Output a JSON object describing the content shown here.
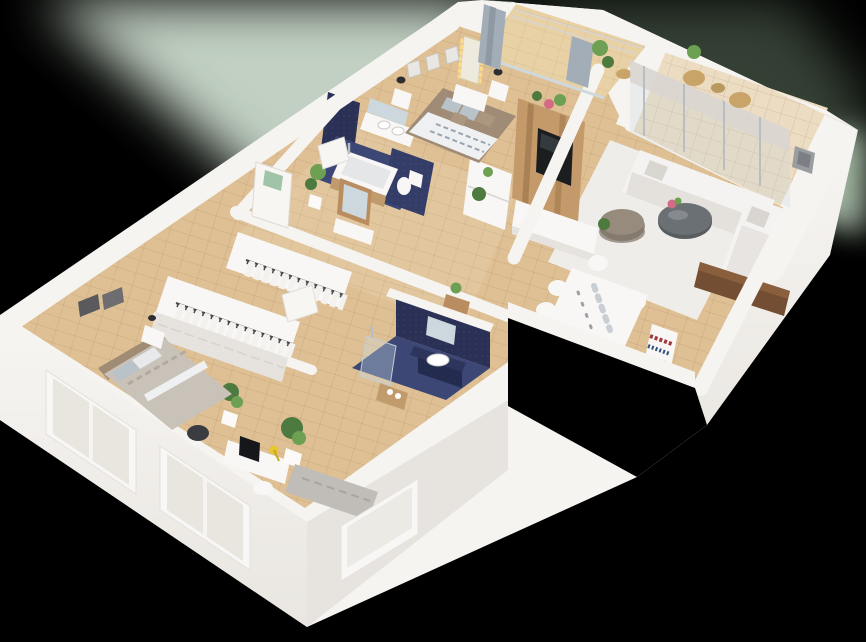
{
  "meta": {
    "kind": "3d-isometric-floorplan-render",
    "view": "cutaway-from-above",
    "visible_text": ""
  },
  "background": {
    "base": "#000000",
    "glow_primary": "#ccdccd",
    "glow_secondary": "#7e997f",
    "glow_accent": "#b7cdb7"
  },
  "palette": {
    "wallTop": "#f6f4f1",
    "facade": "#f3f1ed",
    "facadeShade": "#e7e4df",
    "woodFloor": "#dfc094",
    "woodFloorLight": "#e9d1a6",
    "balconyTile": "#ecdcc2",
    "navyWall": "#2b3156",
    "navyWallLight": "#343d68",
    "navyFloor": "#3d4775",
    "rug": "#efeeec",
    "sofa": "#f4f3f1",
    "sofaShadow": "#d9d6d1",
    "pouf": "#968b7d",
    "poufShade": "#7e7468",
    "coffeeTable": "#585d60",
    "tvWood": "#c49a6a",
    "tvScreen": "#1b1d1f",
    "furnitureWhite": "#f8f7f5",
    "furnitureShade": "#e6e3de",
    "duvetWhite": "#eef0f2",
    "duvetStripe": "#9aa4ae",
    "bedFrame": "#a08b76",
    "pillowGray": "#b9c1c9",
    "pillowTan": "#ab967f",
    "bed2Duvet": "#c9c2b8",
    "bed2Headboard": "#a08b74",
    "monitor": "#15171a",
    "lampYellow": "#e7c633",
    "chairDark": "#3a3c3f",
    "daybed": "#c0bdb8",
    "plantDark": "#4c7a3f",
    "plantLight": "#6da053",
    "pot": "#fbfaf8",
    "door": "#f8f6f3",
    "doorGlass": "#9fc4a8",
    "curtain": "#a3adb8",
    "glassTint": "rgba(196,211,221,0.25)",
    "mirrorGlass": "#cdd7de",
    "woodConsole": "#b98d5f",
    "sideboard": "#744e32",
    "artFrame": "#5a5a5c",
    "artFrame2": "#e9e7e3",
    "lampDark": "#2e2e30",
    "wicker": "#c8a468",
    "blind": "#d9d6d1",
    "tubWood": "#c19b6b",
    "vanityCabinet": "#232b4e",
    "flower": "#d46a84",
    "lineShadow": "#d8d4cf",
    "railDark": "#4a4a4c",
    "clothes": "#f4f2ee",
    "plankLine": "rgba(120,85,40,0.18)",
    "bulbs": "#ffd98a",
    "metal": "#b9bec2"
  },
  "scene": {
    "rooms": [
      {
        "name": "master-bedroom",
        "furniture": [
          "double-bed",
          "nightstand-left",
          "nightstand-right",
          "table-lamps",
          "vanity-mirror-with-lights",
          "vanity-desk",
          "wall-frames",
          "dresser"
        ]
      },
      {
        "name": "master-ensuite-bathroom",
        "furniture": [
          "bathtub",
          "toilet",
          "double-basin-vanity",
          "mirror",
          "navy-tile-walls"
        ]
      },
      {
        "name": "master-balcony",
        "furniture": [
          "curtains",
          "plant-stand",
          "side-table",
          "railing"
        ]
      },
      {
        "name": "living-room",
        "furniture": [
          "l-shaped-sofa",
          "coffee-table",
          "pouf",
          "area-rug",
          "tv-feature-wall",
          "tv",
          "media-console",
          "plants",
          "wall-art"
        ]
      },
      {
        "name": "living-balcony",
        "furniture": [
          "wicker-chairs",
          "bistro-table",
          "potted-plant",
          "roller-blinds",
          "sliding-glass-doors"
        ]
      },
      {
        "name": "dining-area",
        "furniture": [
          "dining-table",
          "six-chairs",
          "place-settings",
          "bookshelf",
          "sideboard"
        ]
      },
      {
        "name": "second-bathroom",
        "furniture": [
          "washbasin-vanity",
          "mirror",
          "shower",
          "towel-cabinet",
          "navy-tile-walls"
        ]
      },
      {
        "name": "hallway",
        "furniture": [
          "front-door",
          "entry-mirror",
          "entry-console",
          "console-table",
          "potted-plants"
        ]
      },
      {
        "name": "walk-in-closet",
        "furniture": [
          "clothes-rail-upper",
          "clothes-rail-lower",
          "drawer-units",
          "open-door"
        ]
      },
      {
        "name": "second-bedroom",
        "furniture": [
          "double-bed",
          "nightstand",
          "wall-art",
          "wardrobe-drawers",
          "desk",
          "monitor",
          "yellow-lamp",
          "desk-chair",
          "side-chair",
          "daybed-bench",
          "potted-plant"
        ]
      }
    ],
    "exterior": [
      "white-facades",
      "facade-windows",
      "notch-cutout",
      "balcony-walls"
    ]
  }
}
